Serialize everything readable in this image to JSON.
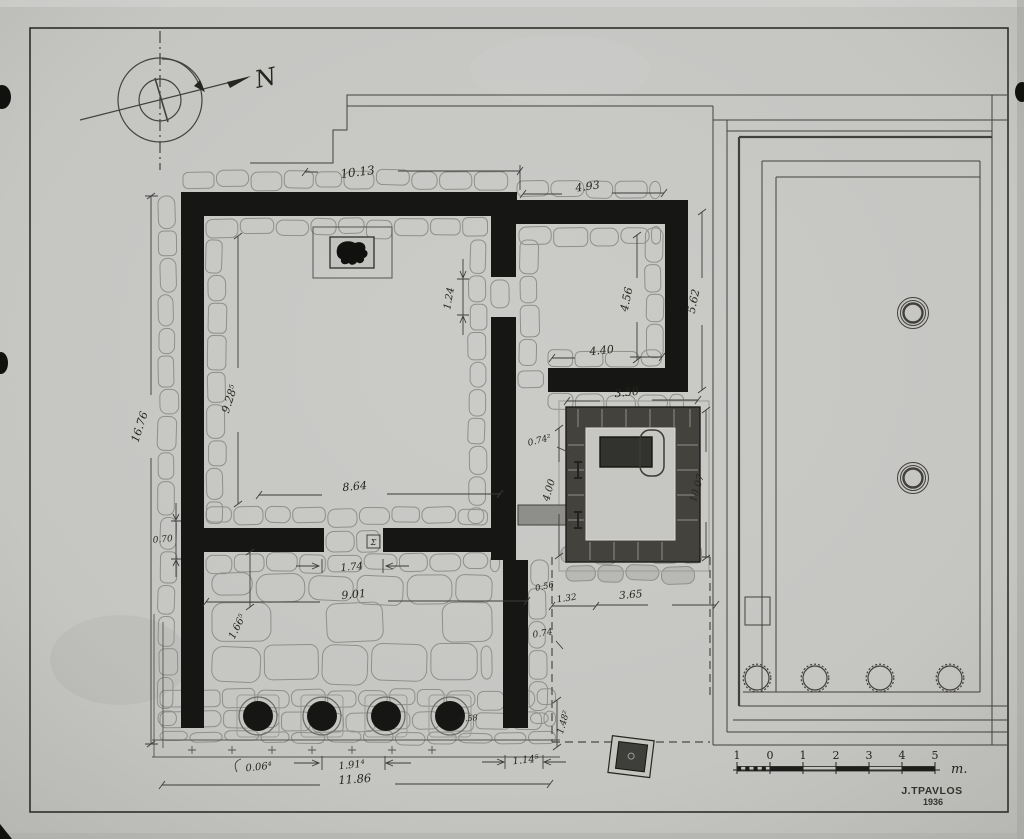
{
  "drawing": {
    "type": "archaeological floor plan",
    "paper_color": "#c7c7c4",
    "ink_color": "#161614"
  },
  "compass": {
    "north_label": "N"
  },
  "dimension_labels": [
    {
      "id": "temple-top-width",
      "text": "10.13"
    },
    {
      "id": "annex-top-width",
      "text": "4.93"
    },
    {
      "id": "annex-inner-height",
      "text": "4.56"
    },
    {
      "id": "annex-outer-height",
      "text": "5.62"
    },
    {
      "id": "annex-bottom-width",
      "text": "4.40"
    },
    {
      "id": "naiskos-top-width",
      "text": "3.50"
    },
    {
      "id": "temple-outer-left-height",
      "text": "16.76"
    },
    {
      "id": "cella-inner-length",
      "text": "9.28⁵"
    },
    {
      "id": "cella-inner-width",
      "text": "8.64"
    },
    {
      "id": "cross-wall-thickness",
      "text": "0.70"
    },
    {
      "id": "cella-door-width",
      "text": "1.74"
    },
    {
      "id": "pronaos-inner-width",
      "text": "9.01"
    },
    {
      "id": "pronaos-depth",
      "text": "1.66⁵"
    },
    {
      "id": "side-door-width",
      "text": "1.24"
    },
    {
      "id": "naiskos-wall-offset",
      "text": "0.74²"
    },
    {
      "id": "naiskos-inner-height",
      "text": "4.00"
    },
    {
      "id": "naiskos-outer-height",
      "text": "10.07"
    },
    {
      "id": "naiskos-step-width",
      "text": "0.56"
    },
    {
      "id": "naiskos-left-offset",
      "text": "1.32"
    },
    {
      "id": "naiskos-bottom-width",
      "text": "3.65"
    },
    {
      "id": "stylobate-offset",
      "text": "0.74"
    },
    {
      "id": "anta-offset",
      "text": "1.48²"
    },
    {
      "id": "front-left-offset",
      "text": "0.06⁴"
    },
    {
      "id": "intercolumniation",
      "text": "1.91⁴"
    },
    {
      "id": "front-total-width",
      "text": "11.86"
    },
    {
      "id": "front-right-offset",
      "text": "1.14⁵"
    },
    {
      "id": "column-diameter",
      "text": "0.58"
    },
    {
      "id": "threshold-mark",
      "text": "Σ"
    }
  ],
  "scale_bar": {
    "tick_labels": [
      "1",
      "0",
      "1",
      "2",
      "3",
      "4",
      "5"
    ],
    "unit_label": "m."
  },
  "signature": {
    "name": "J.TPAVLOS",
    "year": "1936"
  }
}
